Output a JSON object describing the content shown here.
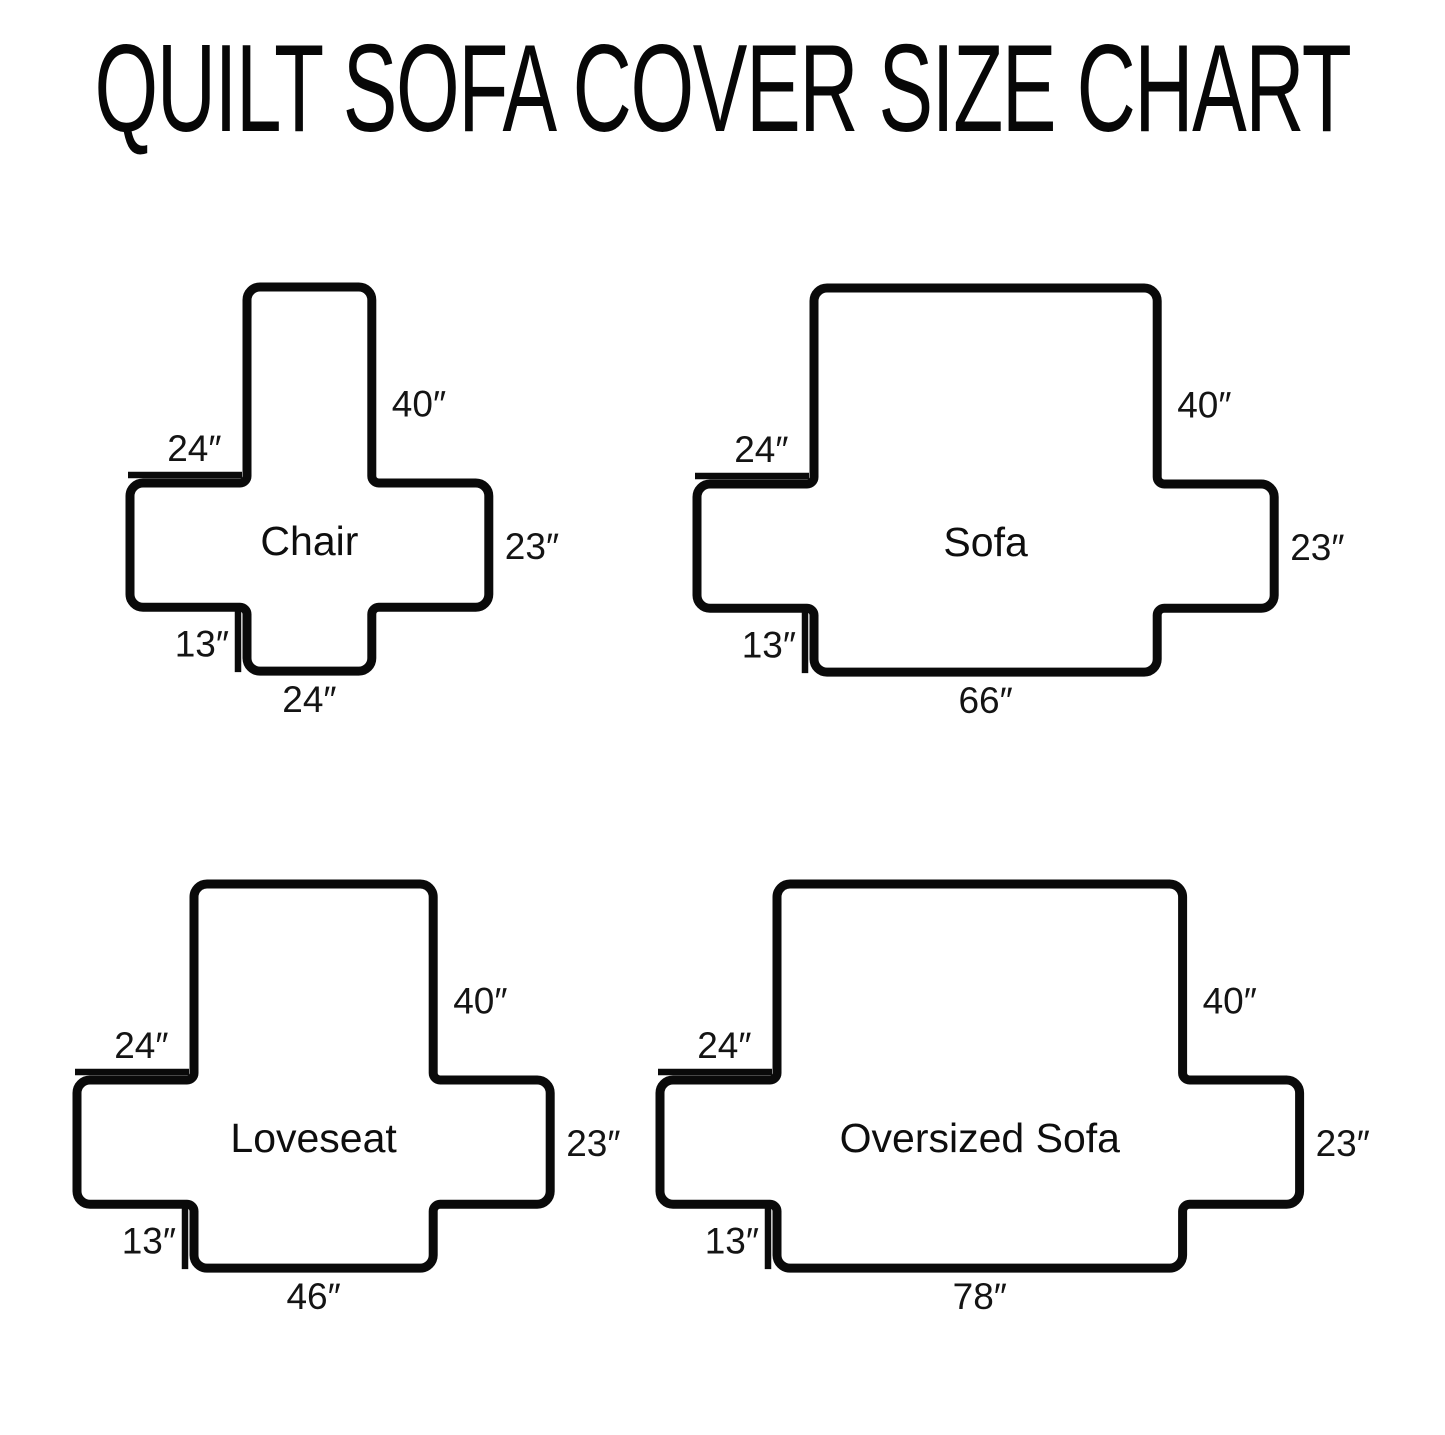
{
  "title": "QUILT SOFA COVER SIZE CHART",
  "diagrams": [
    {
      "slug": "chair",
      "name": "Chair",
      "dimensions": {
        "back_height": {
          "value": 40,
          "label": "40″"
        },
        "arm_top_width": {
          "value": 24,
          "label": "24″"
        },
        "side_height": {
          "value": 23,
          "label": "23″"
        },
        "front_drop": {
          "value": 13,
          "label": "13″"
        },
        "bottom_width": {
          "value": 24,
          "label": "24″"
        }
      }
    },
    {
      "slug": "sofa",
      "name": "Sofa",
      "dimensions": {
        "back_height": {
          "value": 40,
          "label": "40″"
        },
        "arm_top_width": {
          "value": 24,
          "label": "24″"
        },
        "side_height": {
          "value": 23,
          "label": "23″"
        },
        "front_drop": {
          "value": 13,
          "label": "13″"
        },
        "bottom_width": {
          "value": 66,
          "label": "66″"
        }
      }
    },
    {
      "slug": "loveseat",
      "name": "Loveseat",
      "dimensions": {
        "back_height": {
          "value": 40,
          "label": "40″"
        },
        "arm_top_width": {
          "value": 24,
          "label": "24″"
        },
        "side_height": {
          "value": 23,
          "label": "23″"
        },
        "front_drop": {
          "value": 13,
          "label": "13″"
        },
        "bottom_width": {
          "value": 46,
          "label": "46″"
        }
      }
    },
    {
      "slug": "oversized-sofa",
      "name": "Oversized Sofa",
      "dimensions": {
        "back_height": {
          "value": 40,
          "label": "40″"
        },
        "arm_top_width": {
          "value": 24,
          "label": "24″"
        },
        "side_height": {
          "value": 23,
          "label": "23″"
        },
        "front_drop": {
          "value": 13,
          "label": "13″"
        },
        "bottom_width": {
          "value": 78,
          "label": "78″"
        }
      }
    }
  ]
}
